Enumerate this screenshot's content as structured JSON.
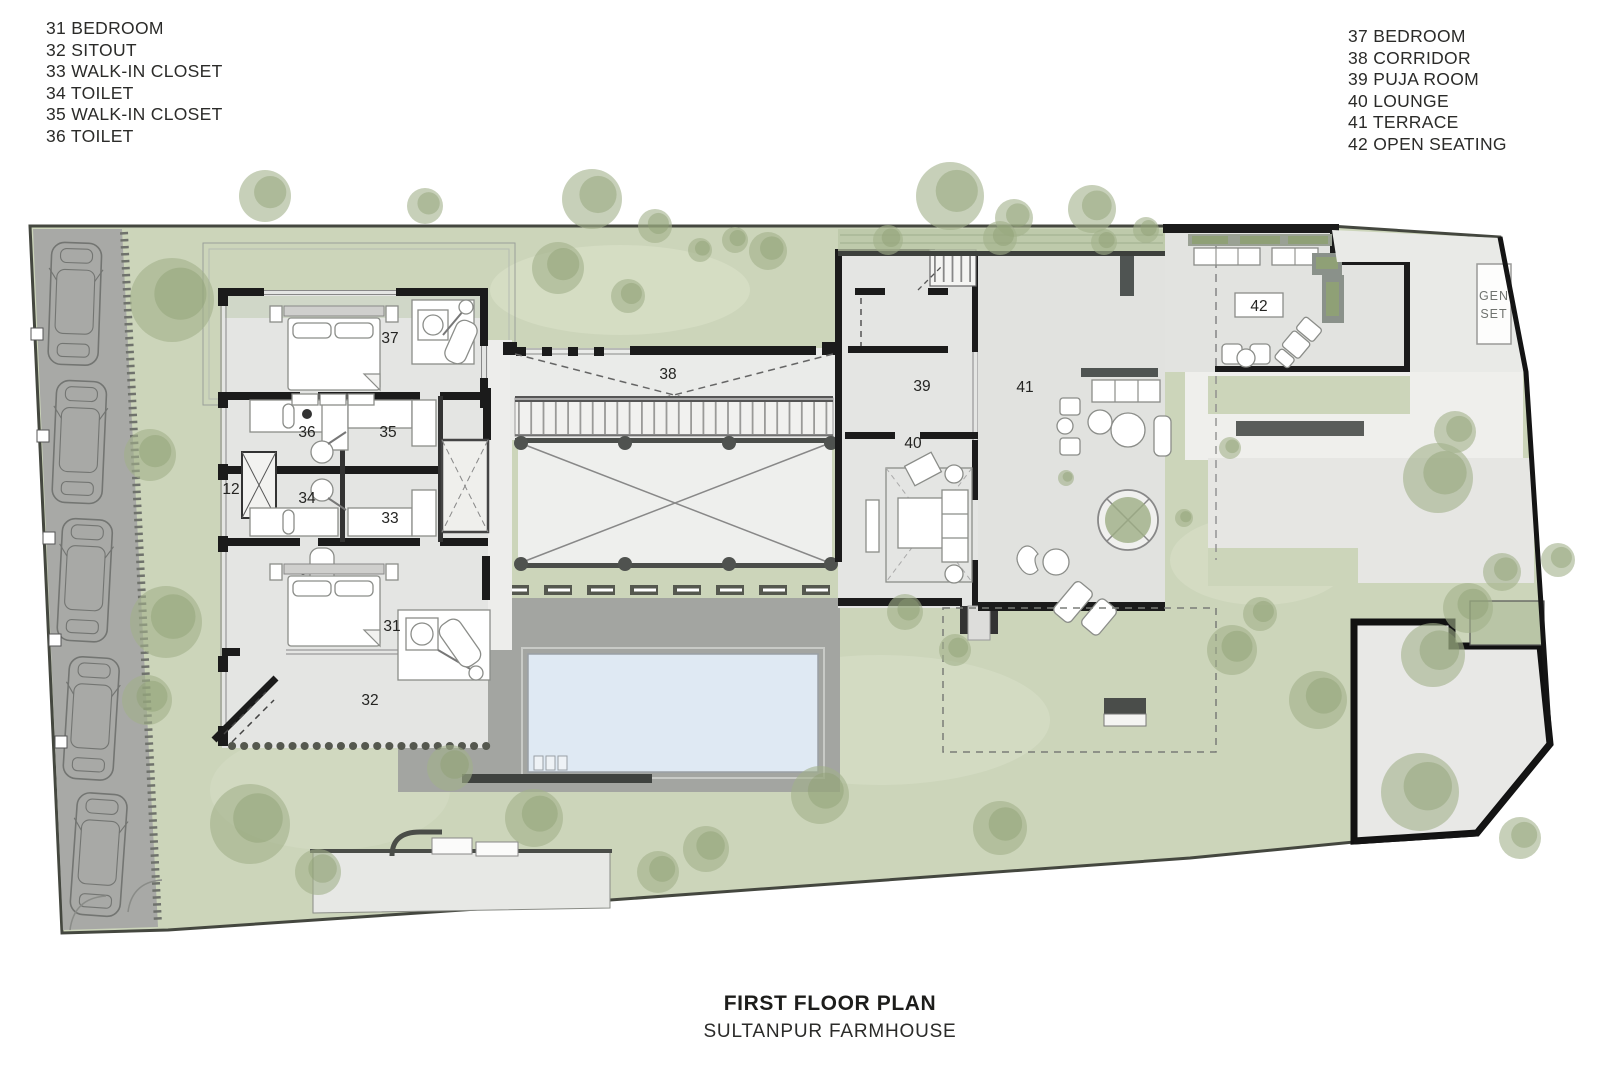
{
  "legend_left": {
    "items": [
      "31 BEDROOM",
      "32 SITOUT",
      "33 WALK-IN CLOSET",
      "34 TOILET",
      "35 WALK-IN CLOSET",
      "36 TOILET"
    ]
  },
  "legend_right": {
    "items": [
      "37 BEDROOM",
      "38 CORRIDOR",
      "39 PUJA ROOM",
      "40 LOUNGE",
      "41 TERRACE",
      "42 OPEN SEATING"
    ]
  },
  "title": {
    "primary": "FIRST FLOOR PLAN",
    "secondary": "SULTANPUR FARMHOUSE"
  },
  "plan": {
    "room_labels": {
      "r12": "12",
      "r31": "31",
      "r32": "32",
      "r33": "33",
      "r34": "34",
      "r35": "35",
      "r36": "36",
      "r37": "37",
      "r38": "38",
      "r39": "39",
      "r40": "40",
      "r41": "41",
      "r42": "42"
    },
    "genset": {
      "line1": "GEN",
      "line2": "SET"
    }
  },
  "colors": {
    "lawn": "#ccd5ba",
    "paving": "#e3e4e2",
    "pool": "#dfe9f3",
    "deck": "#a3a5a1",
    "wall": "#1b1b1b",
    "driveway": "#a8a9a6",
    "tree": "#a2b18a",
    "accent_dark": "#4f5452"
  }
}
